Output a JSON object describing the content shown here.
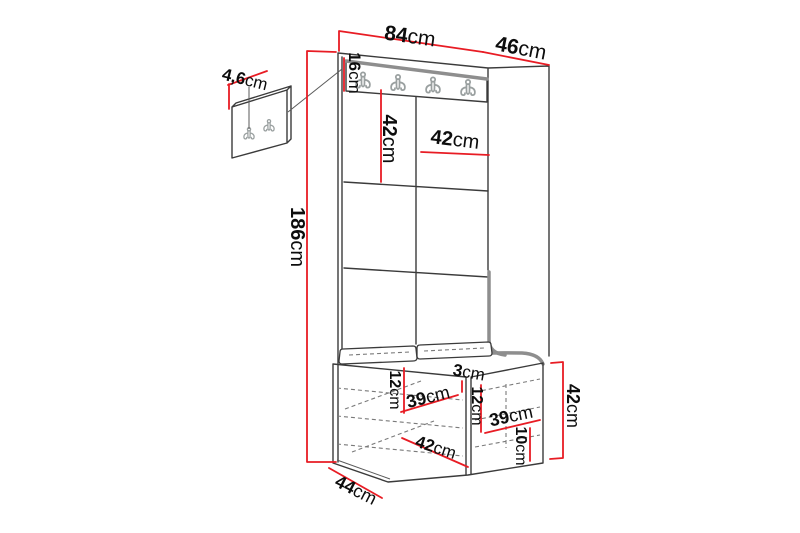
{
  "colors": {
    "background": "#ffffff",
    "dimension_red": "#e81c24",
    "line_dark": "#3b3b3b",
    "line_light": "#5a5a5a",
    "edge_gray": "#8e8e8e",
    "dashed_gray": "#7a7a7a",
    "hook_gray": "#9aa0a0",
    "label_color": "#0d0d0d"
  },
  "diagram": {
    "unit": "cm",
    "hook_count_main": 4,
    "hook_count_detail": 2,
    "labels": [
      {
        "id": "width-84",
        "num": "84",
        "unit": "cm",
        "x": 410,
        "y": 36,
        "rot": 8,
        "size": 21
      },
      {
        "id": "depth-46",
        "num": "46",
        "unit": "cm",
        "x": 521,
        "y": 48,
        "rot": 11,
        "size": 21
      },
      {
        "id": "hookboard-height-16",
        "num": "16",
        "unit": "cm",
        "x": 355,
        "y": 73,
        "rot": 90,
        "size": 17
      },
      {
        "id": "detail-hook-4-6",
        "num": "4,6",
        "unit": "cm",
        "x": 245,
        "y": 79,
        "rot": 14,
        "size": 17
      },
      {
        "id": "panel-height-42",
        "num": "42",
        "unit": "cm",
        "x": 389,
        "y": 139,
        "rot": 90,
        "size": 20
      },
      {
        "id": "panel-width-42",
        "num": "42",
        "unit": "cm",
        "x": 455,
        "y": 140,
        "rot": 7,
        "size": 20
      },
      {
        "id": "total-height-186",
        "num": "186",
        "unit": "cm",
        "x": 297,
        "y": 237,
        "rot": 90,
        "size": 20
      },
      {
        "id": "bench-left-12",
        "num": "12",
        "unit": "cm",
        "x": 395,
        "y": 390,
        "rot": 90,
        "size": 16
      },
      {
        "id": "bench-left-39",
        "num": "39",
        "unit": "cm",
        "x": 428,
        "y": 397,
        "rot": -14,
        "size": 18
      },
      {
        "id": "divider-3",
        "num": "3",
        "unit": "cm",
        "x": 469,
        "y": 372,
        "rot": 10,
        "size": 17
      },
      {
        "id": "bench-mid-12",
        "num": "12",
        "unit": "cm",
        "x": 477,
        "y": 406,
        "rot": 90,
        "size": 16
      },
      {
        "id": "bench-right-39",
        "num": "39",
        "unit": "cm",
        "x": 511,
        "y": 416,
        "rot": -12,
        "size": 18
      },
      {
        "id": "bench-bottom-10",
        "num": "10",
        "unit": "cm",
        "x": 521,
        "y": 446,
        "rot": 90,
        "size": 16
      },
      {
        "id": "bench-diag-42",
        "num": "42",
        "unit": "cm",
        "x": 436,
        "y": 447,
        "rot": 18,
        "size": 17
      },
      {
        "id": "bench-depth-44",
        "num": "44",
        "unit": "cm",
        "x": 356,
        "y": 490,
        "rot": 27,
        "size": 18
      },
      {
        "id": "bench-height-42",
        "num": "42",
        "unit": "cm",
        "x": 573,
        "y": 406,
        "rot": 90,
        "size": 18
      }
    ]
  }
}
